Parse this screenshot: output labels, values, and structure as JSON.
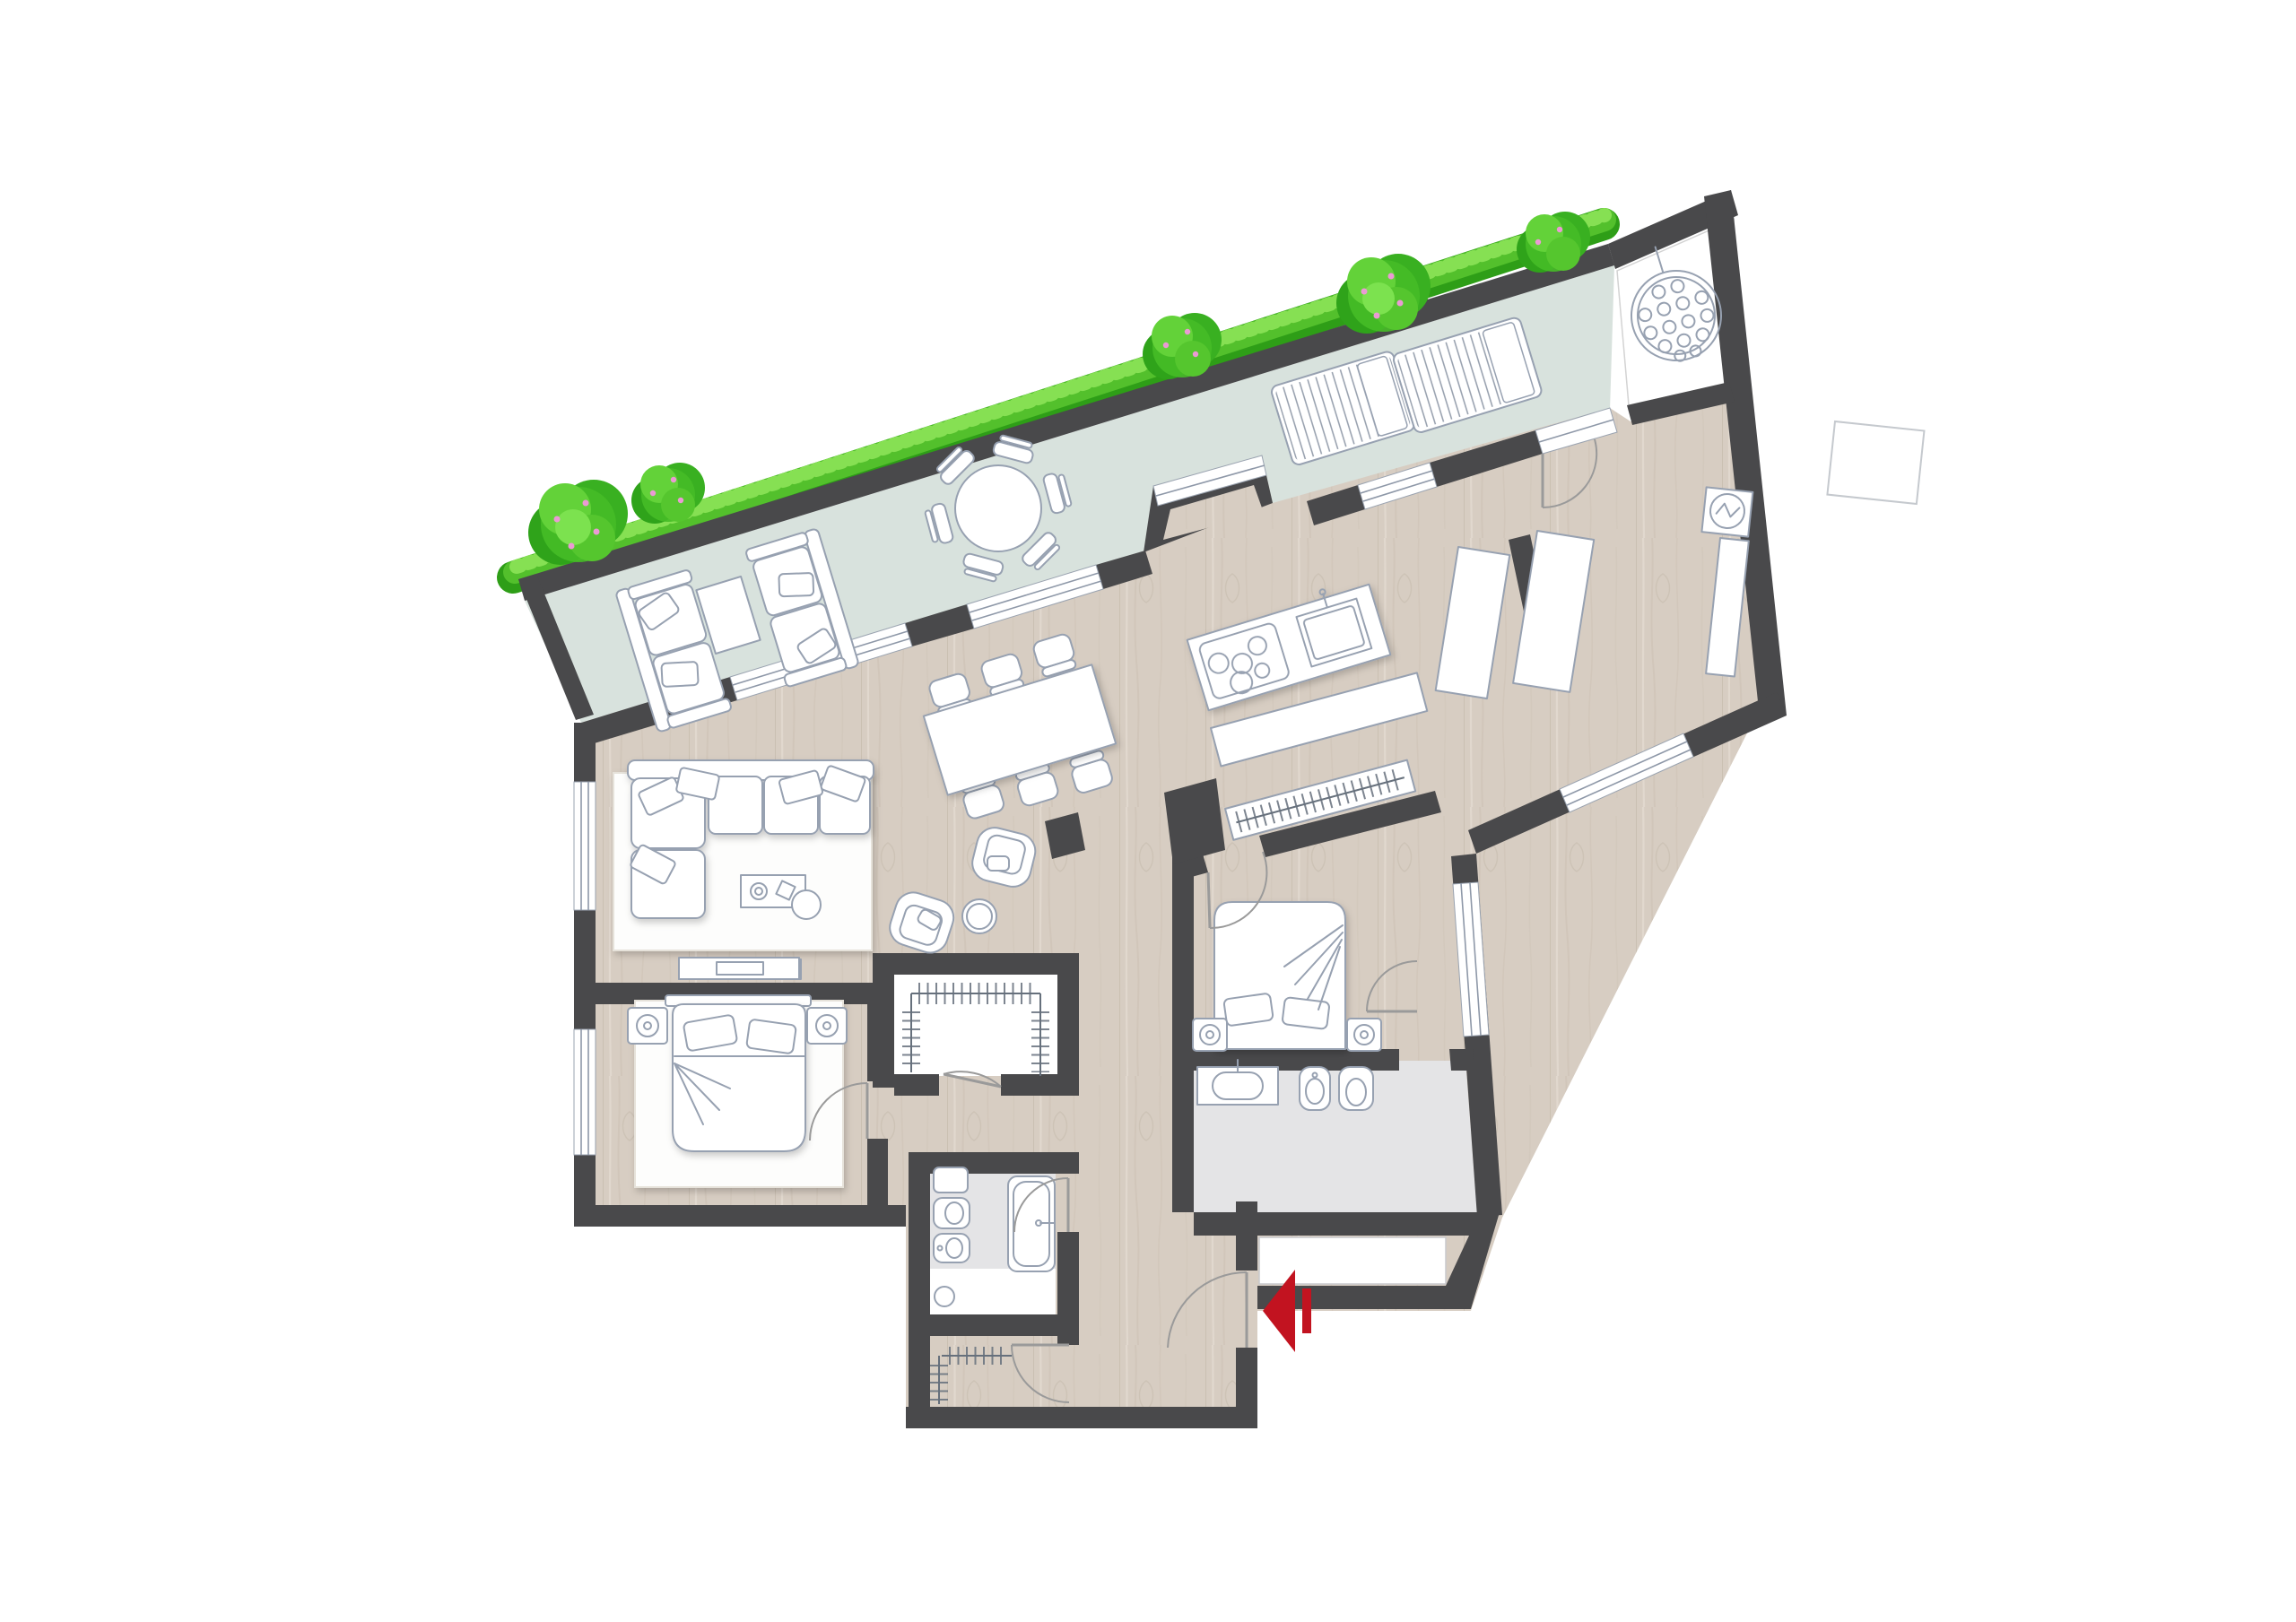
{
  "meta": {
    "title": "Apartment floor plan with roof terrace",
    "type": "architectural-floor-plan",
    "view": "top-down rendered plan",
    "visible_text": "none"
  },
  "colors": {
    "background": "#ffffff",
    "wall": "#49494b",
    "wood_base": "#d7cdc2",
    "wood_grain": "#c8bcae",
    "wood_light": "#e3dbd1",
    "terrace_floor": "#d8e2dd",
    "bath_floor": "#e4e4e6",
    "furniture_fill": "#ffffff",
    "furniture_stroke": "#97a1b1",
    "grass_dark": "#2e9e17",
    "grass_main": "#53c02c",
    "grass_light": "#86e053",
    "blossom_pink": "#eb9ad4",
    "accent_red": "#c21320"
  },
  "entrance": {
    "marker": "red arrow with bar",
    "direction": "pointing left into apartment",
    "location": "lower right exterior wall"
  },
  "counts": {
    "bedrooms": 2,
    "bathrooms": 2,
    "hob_burners": 5,
    "dining_chairs": 6,
    "terrace_table_chairs": 6,
    "sun_loungers": 2,
    "outdoor_loveseats": 2,
    "hot_tub_jets": 15,
    "flowering_shrubs": 5
  },
  "rooms": [
    {
      "id": "roof-terrace",
      "name": "Roof terrace",
      "floor": "pale sage decking",
      "furniture": [
        "outdoor loveseat x2",
        "outdoor side table",
        "round dining table",
        "terrace chair x6",
        "sun lounger x2"
      ],
      "planting": [
        "continuous grass strip along parapet",
        "flowering shrub x5 with pink blossoms"
      ]
    },
    {
      "id": "spa-room",
      "name": "Spa room (top right)",
      "floor": "white",
      "furniture": [
        "round hot tub with jet nozzles and inlet stem"
      ]
    },
    {
      "id": "living-area",
      "name": "Living area",
      "floor": "wood",
      "furniture": [
        "L-shaped sofa",
        "area rug",
        "coffee table with decor",
        "pouf",
        "armchair x2",
        "round side table",
        "TV sideboard"
      ]
    },
    {
      "id": "dining-area",
      "name": "Dining area",
      "floor": "wood",
      "furniture": [
        "rectangular dining table",
        "dining chair x6",
        "structural pillar"
      ]
    },
    {
      "id": "kitchen",
      "name": "Kitchen",
      "floor": "wood",
      "furniture": [
        "island with 5-burner hob and sink",
        "counter sideboard",
        "wardrobe strip with hanging rail"
      ]
    },
    {
      "id": "entry-corridor",
      "name": "Right-wing corridor",
      "floor": "wood",
      "furniture": [
        "built-in wardrobe x2",
        "tall cabinet",
        "electrical panel with circuit symbol",
        "exterior ledge"
      ]
    },
    {
      "id": "bedroom-2",
      "name": "Bedroom 2 (right)",
      "floor": "wood",
      "furniture": [
        "double bed",
        "nightstand with lamp x2"
      ]
    },
    {
      "id": "ensuite-bathroom",
      "name": "En-suite bathroom",
      "floor": "light gray tile",
      "furniture": [
        "washbasin counter",
        "bidet",
        "toilet",
        "linen closet niche"
      ]
    },
    {
      "id": "bedroom-1",
      "name": "Bedroom 1 (bottom left)",
      "floor": "wood",
      "furniture": [
        "double bed",
        "nightstand with lamp x2",
        "area rug",
        "dresser"
      ]
    },
    {
      "id": "walk-in-closet",
      "name": "Walk-in closet",
      "floor": "white",
      "furniture": [
        "U-shaped hanging rails"
      ]
    },
    {
      "id": "main-bathroom",
      "name": "Main bathroom",
      "floor": "light gray tile + white shower zone",
      "furniture": [
        "washbasin",
        "wall-hung toilet",
        "bidet",
        "bathtub",
        "shower drain"
      ]
    },
    {
      "id": "entry-closet",
      "name": "Entry closet",
      "floor": "wood",
      "furniture": [
        "L-shaped hanging rails"
      ]
    },
    {
      "id": "entrance-hall",
      "name": "Entrance hall",
      "floor": "wood",
      "furniture": []
    }
  ]
}
